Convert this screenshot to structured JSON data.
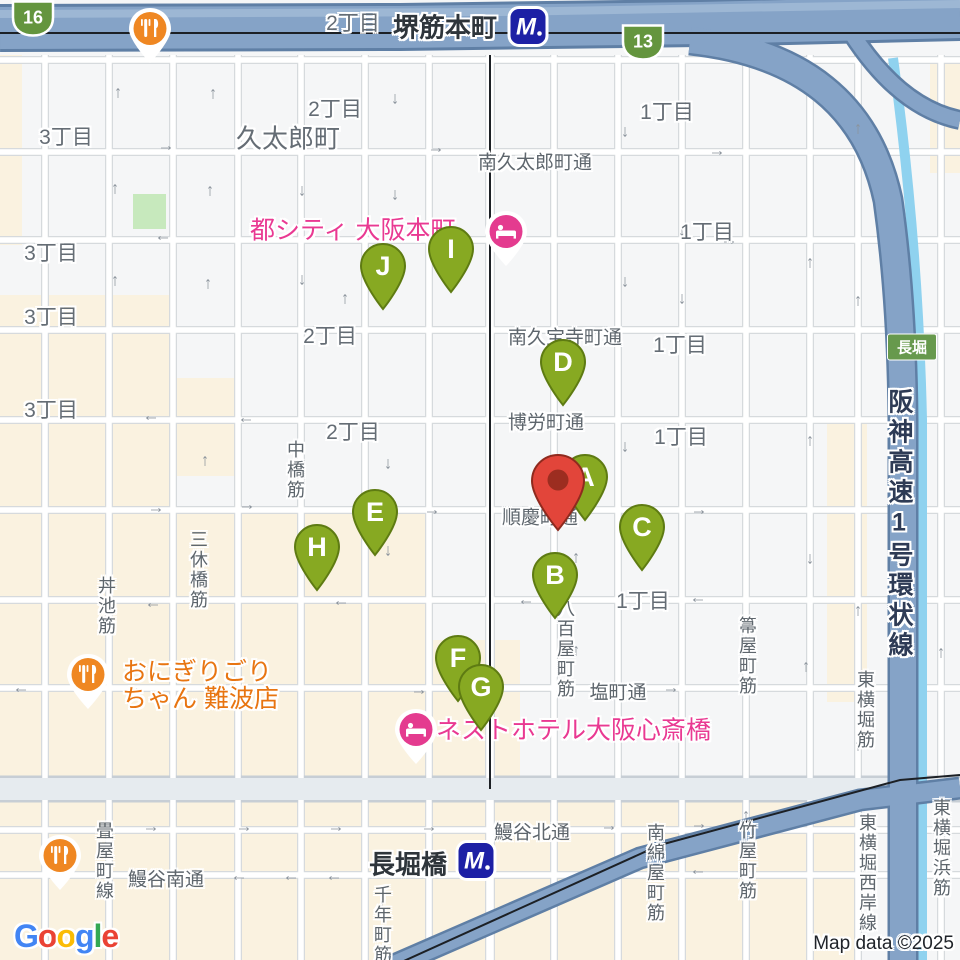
{
  "attribution": {
    "map_data": "Map data ©2025",
    "logo_letters": [
      {
        "ch": "G",
        "color": "#4285F4"
      },
      {
        "ch": "o",
        "color": "#EA4335"
      },
      {
        "ch": "o",
        "color": "#FBBC05"
      },
      {
        "ch": "g",
        "color": "#4285F4"
      },
      {
        "ch": "l",
        "color": "#34A853"
      },
      {
        "ch": "e",
        "color": "#EA4335"
      }
    ]
  },
  "map": {
    "colors": {
      "marker_green": "#87a922",
      "marker_green_stroke": "#5e7b12",
      "destination_red": "#e2453a",
      "destination_red_inner": "#9c2d20",
      "hotel_pink": "#e43b8f",
      "restaurant_orange": "#ef8722",
      "metro_blue": "#1d20a5",
      "shield_green": "#64953e",
      "highway_fill": "#85a3c7",
      "beige_block": "#faf2e0",
      "park_green": "#c7e9bd",
      "canal_blue": "#8fd2ef"
    },
    "stations": [
      {
        "name": "堺筋本町",
        "label_x": 445,
        "label_y": 26,
        "icon_x": 528,
        "icon_y": 29
      },
      {
        "name": "長堀橋",
        "label_x": 408,
        "label_y": 863,
        "icon_x": 476,
        "icon_y": 863
      }
    ],
    "route_shields": [
      {
        "label": "16",
        "x": 33,
        "y": 21
      },
      {
        "label": "13",
        "x": 643,
        "y": 45
      }
    ],
    "road_badge": {
      "label": "長堀",
      "x": 912,
      "y": 347
    },
    "highway_name": {
      "text": "阪神高速1号環状線"
    },
    "street_names_h": [
      {
        "text": "南久太郎町通",
        "x": 535,
        "y": 161
      },
      {
        "text": "南久宝寺町通",
        "x": 565,
        "y": 336
      },
      {
        "text": "博労町通",
        "x": 546,
        "y": 421
      },
      {
        "text": "順慶町通",
        "x": 540,
        "y": 516
      },
      {
        "text": "塩町通",
        "x": 618,
        "y": 691
      },
      {
        "text": "鰻谷北通",
        "x": 532,
        "y": 831
      },
      {
        "text": "鰻谷南通",
        "x": 166,
        "y": 878
      }
    ],
    "street_names_v": [
      {
        "text": "中橋筋",
        "x": 295,
        "y": 470
      },
      {
        "text": "三休橋筋",
        "x": 198,
        "y": 570
      },
      {
        "text": "丼池筋",
        "x": 106,
        "y": 606
      },
      {
        "text": "八百屋町筋",
        "x": 565,
        "y": 649
      },
      {
        "text": "箒屋町筋",
        "x": 747,
        "y": 656
      },
      {
        "text": "東横堀筋",
        "x": 865,
        "y": 710
      },
      {
        "text": "畳屋町線",
        "x": 104,
        "y": 861
      },
      {
        "text": "千年町筋",
        "x": 382,
        "y": 925
      },
      {
        "text": "南綿屋町筋",
        "x": 655,
        "y": 873
      },
      {
        "text": "竹屋町筋",
        "x": 747,
        "y": 861
      },
      {
        "text": "東横堀西岸線",
        "x": 867,
        "y": 873
      },
      {
        "text": "東横堀浜筋",
        "x": 941,
        "y": 848
      }
    ],
    "district_labels": [
      {
        "text": "2丁目",
        "x": 353,
        "y": 22,
        "big": false
      },
      {
        "text": "2丁目",
        "x": 335,
        "y": 108,
        "big": false
      },
      {
        "text": "3丁目",
        "x": 66,
        "y": 136,
        "big": false
      },
      {
        "text": "久太郎町",
        "x": 288,
        "y": 137,
        "big": true
      },
      {
        "text": "1丁目",
        "x": 667,
        "y": 111,
        "big": false
      },
      {
        "text": "1丁目",
        "x": 707,
        "y": 231,
        "big": false
      },
      {
        "text": "3丁目",
        "x": 51,
        "y": 252,
        "big": false
      },
      {
        "text": "3丁目",
        "x": 51,
        "y": 316,
        "big": false
      },
      {
        "text": "2丁目",
        "x": 330,
        "y": 335,
        "big": false
      },
      {
        "text": "1丁目",
        "x": 680,
        "y": 344,
        "big": false
      },
      {
        "text": "3丁目",
        "x": 51,
        "y": 409,
        "big": false
      },
      {
        "text": "2丁目",
        "x": 353,
        "y": 431,
        "big": false
      },
      {
        "text": "1丁目",
        "x": 681,
        "y": 436,
        "big": false
      },
      {
        "text": "1丁目",
        "x": 643,
        "y": 600,
        "big": false
      }
    ],
    "pois": [
      {
        "type": "hotel",
        "name": "都シティ 大阪本町",
        "lines": [
          "都シティ 大阪本町"
        ],
        "text_x": 250,
        "text_y": 231,
        "pin_x": 506,
        "pin_y": 231
      },
      {
        "type": "hotel",
        "name": "ネストホテル大阪心斎橋",
        "lines": [
          "ネストホテル大阪心斎橋"
        ],
        "text_x": 436,
        "text_y": 731,
        "pin_x": 416,
        "pin_y": 729
      },
      {
        "type": "restaurant",
        "name": "おにぎりごりちゃん 難波店",
        "lines": [
          "おにぎりごり",
          "ちゃん 難波店"
        ],
        "text_x": 122,
        "text_y": 686,
        "pin_x": 88,
        "pin_y": 674
      },
      {
        "type": "restaurant",
        "name": "",
        "lines": [],
        "text_x": 0,
        "text_y": 0,
        "pin_x": 150,
        "pin_y": 28
      },
      {
        "type": "restaurant",
        "name": "",
        "lines": [],
        "text_x": 0,
        "text_y": 0,
        "pin_x": 60,
        "pin_y": 855
      }
    ],
    "markers": [
      {
        "letter": "D",
        "x": 563,
        "y": 362
      },
      {
        "letter": "I",
        "x": 451,
        "y": 249
      },
      {
        "letter": "J",
        "x": 383,
        "y": 266
      },
      {
        "letter": "H",
        "x": 317,
        "y": 547
      },
      {
        "letter": "E",
        "x": 375,
        "y": 512
      },
      {
        "letter": "C",
        "x": 642,
        "y": 527
      },
      {
        "letter": "B",
        "x": 555,
        "y": 575
      },
      {
        "letter": "F",
        "x": 458,
        "y": 658
      },
      {
        "letter": "G",
        "x": 481,
        "y": 687
      },
      {
        "letter": "A",
        "x": 585,
        "y": 477
      }
    ],
    "destination_pin": {
      "x": 558,
      "y": 480
    },
    "arrows": [
      {
        "x": 118,
        "y": 92,
        "dir": "up"
      },
      {
        "x": 213,
        "y": 93,
        "dir": "up"
      },
      {
        "x": 395,
        "y": 100,
        "dir": "down"
      },
      {
        "x": 625,
        "y": 133,
        "dir": "down"
      },
      {
        "x": 167,
        "y": 148,
        "dir": "right"
      },
      {
        "x": 437,
        "y": 150,
        "dir": "right"
      },
      {
        "x": 718,
        "y": 153,
        "dir": "right"
      },
      {
        "x": 858,
        "y": 128,
        "dir": "up"
      },
      {
        "x": 115,
        "y": 188,
        "dir": "up"
      },
      {
        "x": 210,
        "y": 190,
        "dir": "up"
      },
      {
        "x": 302,
        "y": 192,
        "dir": "down"
      },
      {
        "x": 395,
        "y": 196,
        "dir": "down"
      },
      {
        "x": 682,
        "y": 232,
        "dir": "down"
      },
      {
        "x": 162,
        "y": 238,
        "dir": "left"
      },
      {
        "x": 730,
        "y": 242,
        "dir": "right"
      },
      {
        "x": 115,
        "y": 280,
        "dir": "up"
      },
      {
        "x": 208,
        "y": 283,
        "dir": "up"
      },
      {
        "x": 302,
        "y": 281,
        "dir": "down"
      },
      {
        "x": 625,
        "y": 283,
        "dir": "down"
      },
      {
        "x": 810,
        "y": 262,
        "dir": "up"
      },
      {
        "x": 345,
        "y": 298,
        "dir": "up"
      },
      {
        "x": 682,
        "y": 300,
        "dir": "down"
      },
      {
        "x": 858,
        "y": 300,
        "dir": "up"
      },
      {
        "x": 150,
        "y": 418,
        "dir": "left"
      },
      {
        "x": 245,
        "y": 420,
        "dir": "left"
      },
      {
        "x": 205,
        "y": 460,
        "dir": "up"
      },
      {
        "x": 388,
        "y": 465,
        "dir": "down"
      },
      {
        "x": 625,
        "y": 448,
        "dir": "down"
      },
      {
        "x": 810,
        "y": 440,
        "dir": "up"
      },
      {
        "x": 157,
        "y": 510,
        "dir": "right"
      },
      {
        "x": 248,
        "y": 507,
        "dir": "right"
      },
      {
        "x": 433,
        "y": 512,
        "dir": "right"
      },
      {
        "x": 700,
        "y": 512,
        "dir": "right"
      },
      {
        "x": 912,
        "y": 500,
        "dir": "up"
      },
      {
        "x": 388,
        "y": 552,
        "dir": "down"
      },
      {
        "x": 576,
        "y": 557,
        "dir": "up"
      },
      {
        "x": 810,
        "y": 560,
        "dir": "down"
      },
      {
        "x": 152,
        "y": 605,
        "dir": "left"
      },
      {
        "x": 340,
        "y": 603,
        "dir": "left"
      },
      {
        "x": 525,
        "y": 602,
        "dir": "left"
      },
      {
        "x": 697,
        "y": 600,
        "dir": "left"
      },
      {
        "x": 858,
        "y": 610,
        "dir": "up"
      },
      {
        "x": 20,
        "y": 690,
        "dir": "left"
      },
      {
        "x": 135,
        "y": 690,
        "dir": "right"
      },
      {
        "x": 420,
        "y": 692,
        "dir": "right"
      },
      {
        "x": 672,
        "y": 690,
        "dir": "right"
      },
      {
        "x": 806,
        "y": 666,
        "dir": "up"
      },
      {
        "x": 576,
        "y": 650,
        "dir": "up"
      },
      {
        "x": 746,
        "y": 640,
        "dir": "down"
      },
      {
        "x": 152,
        "y": 829,
        "dir": "right"
      },
      {
        "x": 245,
        "y": 829,
        "dir": "right"
      },
      {
        "x": 337,
        "y": 829,
        "dir": "right"
      },
      {
        "x": 430,
        "y": 829,
        "dir": "right"
      },
      {
        "x": 610,
        "y": 828,
        "dir": "right"
      },
      {
        "x": 700,
        "y": 826,
        "dir": "right"
      },
      {
        "x": 941,
        "y": 820,
        "dir": "up"
      },
      {
        "x": 238,
        "y": 878,
        "dir": "left"
      },
      {
        "x": 290,
        "y": 878,
        "dir": "left"
      },
      {
        "x": 333,
        "y": 878,
        "dir": "left"
      },
      {
        "x": 697,
        "y": 872,
        "dir": "left"
      },
      {
        "x": 382,
        "y": 907,
        "dir": "down"
      },
      {
        "x": 746,
        "y": 815,
        "dir": "up"
      },
      {
        "x": 941,
        "y": 652,
        "dir": "up"
      },
      {
        "x": 858,
        "y": 745,
        "dir": "up"
      }
    ]
  }
}
